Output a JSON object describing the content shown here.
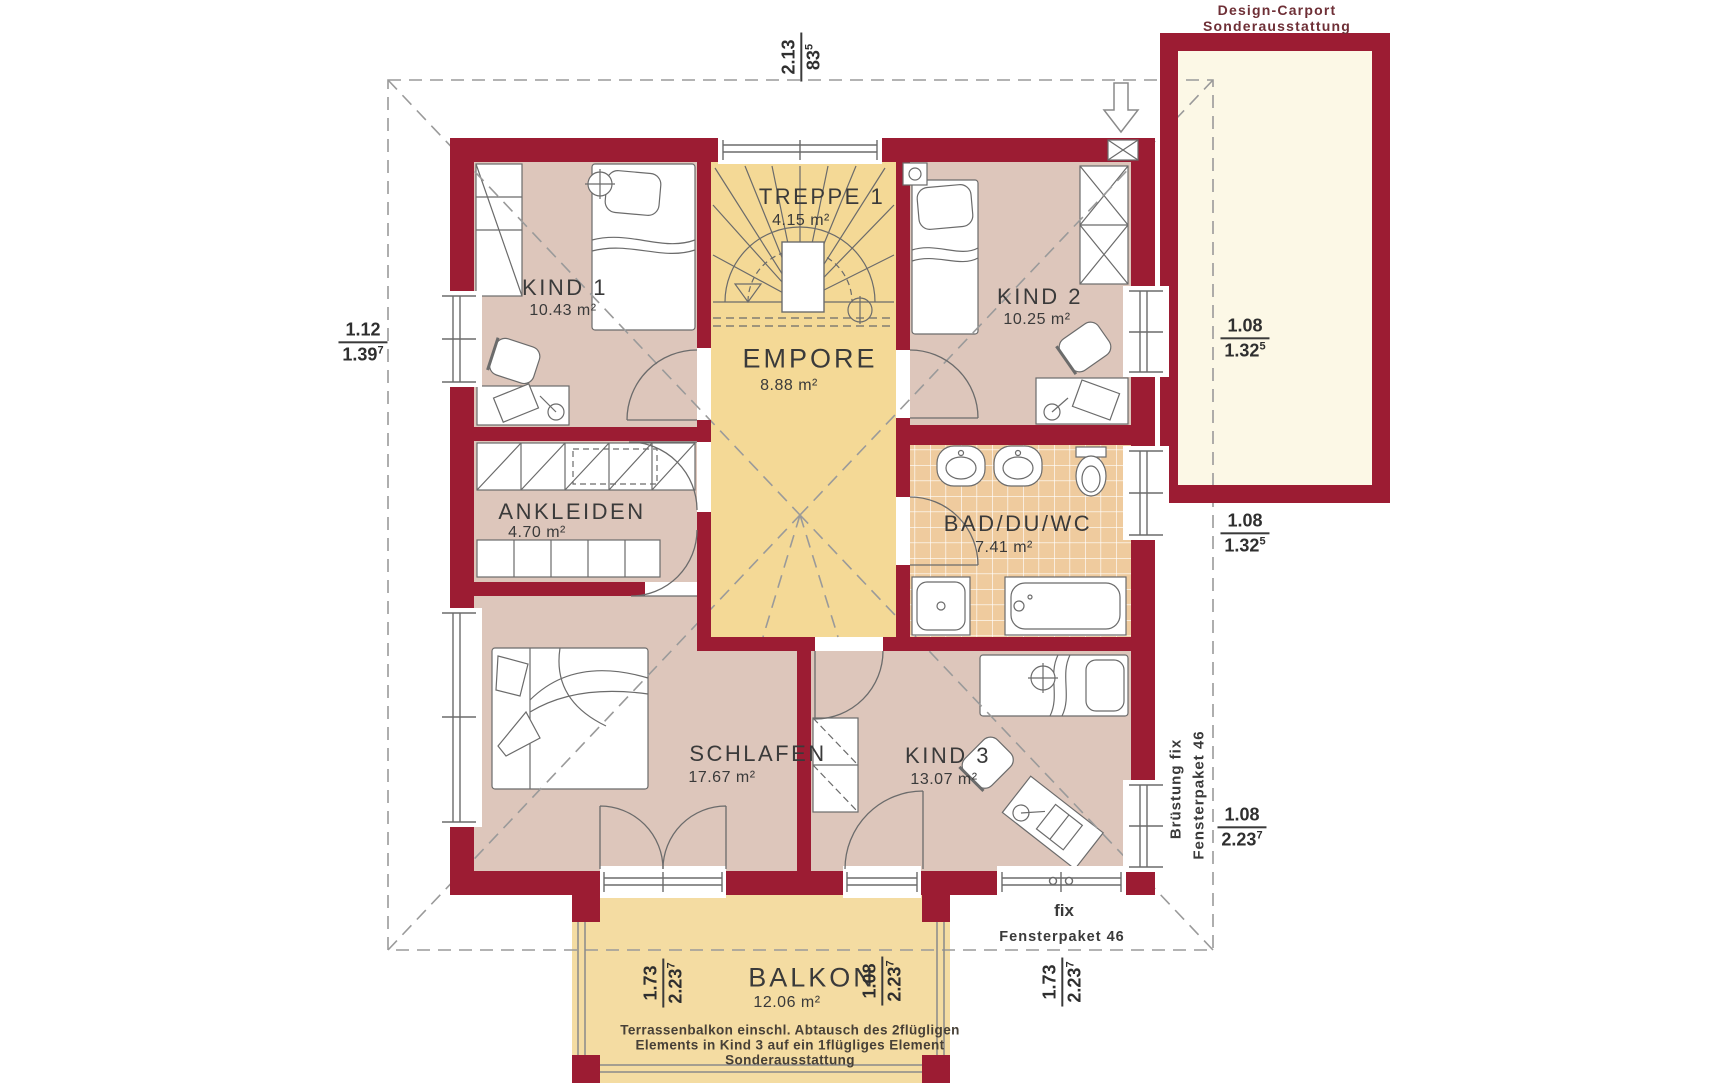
{
  "plan": {
    "carport_label": [
      "Design-Carport",
      "Sonderausstattung"
    ],
    "rooms": {
      "treppe": {
        "name": "TREPPE 1",
        "area": "4.15 m²"
      },
      "kind1": {
        "name": "KIND 1",
        "area": "10.43 m²"
      },
      "kind2": {
        "name": "KIND 2",
        "area": "10.25 m²"
      },
      "empore": {
        "name": "EMPORE",
        "area": "8.88 m²"
      },
      "ankleiden": {
        "name": "ANKLEIDEN",
        "area": "4.70 m²"
      },
      "bad": {
        "name": "BAD/DU/WC",
        "area": "7.41 m²"
      },
      "schlafen": {
        "name": "SCHLAFEN",
        "area": "17.67 m²"
      },
      "kind3": {
        "name": "KIND 3",
        "area": "13.07 m²"
      },
      "balkon": {
        "name": "BALKON",
        "area": "12.06 m²"
      }
    },
    "dimensions": {
      "top": {
        "num": "2.13",
        "den": "83",
        "sup": "5"
      },
      "left": {
        "num": "1.12",
        "den": "1.39",
        "sup": "7"
      },
      "right_upper": {
        "num": "1.08",
        "den": "1.32",
        "sup": "5"
      },
      "right_middle": {
        "num": "1.08",
        "den": "1.32",
        "sup": "5"
      },
      "right_lower": {
        "num": "1.08",
        "den": "2.23",
        "sup": "7"
      },
      "balkon_left": {
        "num": "1.73",
        "den": "2.23",
        "sup": "7"
      },
      "balkon_right": {
        "num": "1.08",
        "den": "2.23",
        "sup": "7"
      },
      "bottom_right": {
        "num": "1.73",
        "den": "2.23",
        "sup": "7"
      }
    },
    "annotations": {
      "bruestung_fix": "Brüstung fix",
      "fensterpaket_vertical": "Fensterpaket 46",
      "fix": "fix",
      "fensterpaket_bottom": "Fensterpaket 46",
      "balkon_note": [
        "Terrassenbalkon einschl. Abtausch des 2flügligen",
        "Elements in Kind 3 auf ein 1flügliges Element",
        "Sonderausstattung"
      ]
    }
  },
  "colors": {
    "wall": "#9c1c33",
    "floor_mauve": "#ddc6bb",
    "floor_yellow": "#f4d996",
    "floor_balkon": "#f4dca2",
    "tile": "#efcb9e",
    "carport_floor": "#fcf8e6",
    "line_gray": "#6b6b6b",
    "dash_gray": "#9a9a9a",
    "text_dark": "#3a3a3a",
    "text_note": "#474037",
    "text_carport": "#6e2f36"
  }
}
